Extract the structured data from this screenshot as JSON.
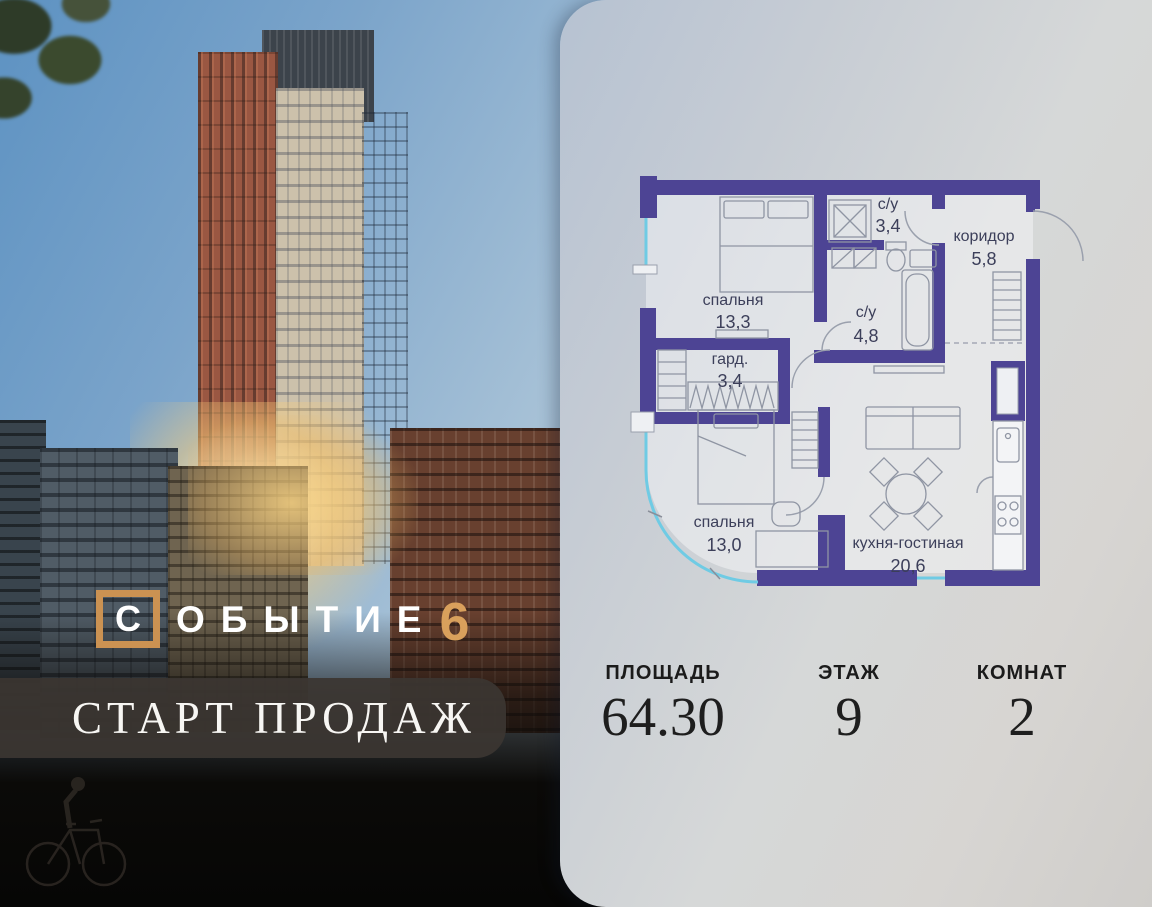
{
  "brand": {
    "first_letter": "С",
    "rest": "ОБЫТИЕ",
    "number": "6",
    "banner_text": "СТАРТ ПРОДАЖ"
  },
  "floor_plan": {
    "rooms": [
      {
        "name": "спальня",
        "area": "13,3"
      },
      {
        "name": "гард.",
        "area": "3,4"
      },
      {
        "name": "с/у",
        "area": "3,4"
      },
      {
        "name": "коридор",
        "area": "5,8"
      },
      {
        "name": "с/у",
        "area": "4,8"
      },
      {
        "name": "спальня",
        "area": "13,0"
      },
      {
        "name": "кухня-гостиная",
        "area": "20,6"
      }
    ]
  },
  "stats": [
    {
      "label": "ПЛОЩАДЬ",
      "value": "64.30"
    },
    {
      "label": "ЭТАЖ",
      "value": "9"
    },
    {
      "label": "КОМНАТ",
      "value": "2"
    }
  ],
  "colors": {
    "accent_gold": "#cb9252",
    "wall_purple": "#4d4494",
    "window_cyan": "#6fcbe4"
  }
}
